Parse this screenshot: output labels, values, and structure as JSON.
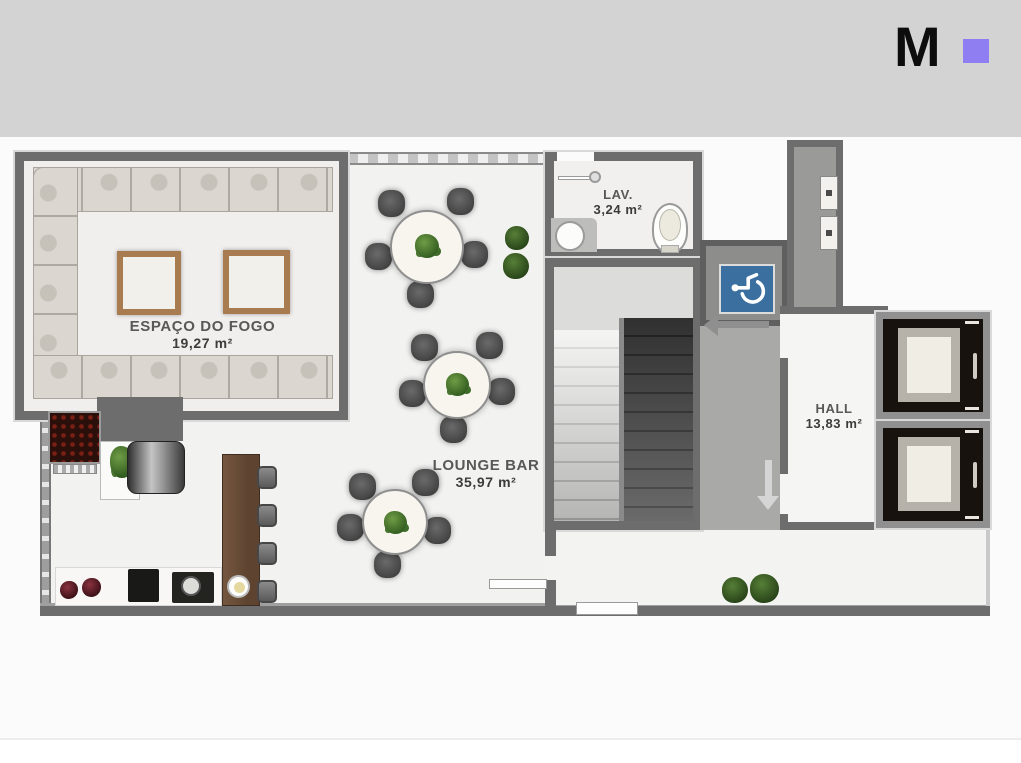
{
  "brand": {
    "logo_letter": "M",
    "accent_color": "#8f7ef2"
  },
  "rooms": {
    "espaco": {
      "label": "ESPAÇO DO FOGO",
      "area": "19,27 m²"
    },
    "lounge": {
      "label": "LOUNGE BAR",
      "area": "35,97 m²"
    },
    "lav": {
      "label": "LAV.",
      "area": "3,24 m²"
    },
    "hall": {
      "label": "HALL",
      "area": "13,83 m²"
    }
  },
  "icons": {
    "accessible_sign": "wheelchair-icon",
    "circulation_arrows": [
      "arrow-left",
      "arrow-down",
      "arrow-down"
    ]
  },
  "colors": {
    "top_band": "#d3d3d3",
    "wall": "#6d6d6d",
    "accessible_sign_blue": "#3a6f9f",
    "bar_counter_wood": "#6b4f3a",
    "fire_table_frame": "#a87c50",
    "floor": "#f1f1f0"
  }
}
